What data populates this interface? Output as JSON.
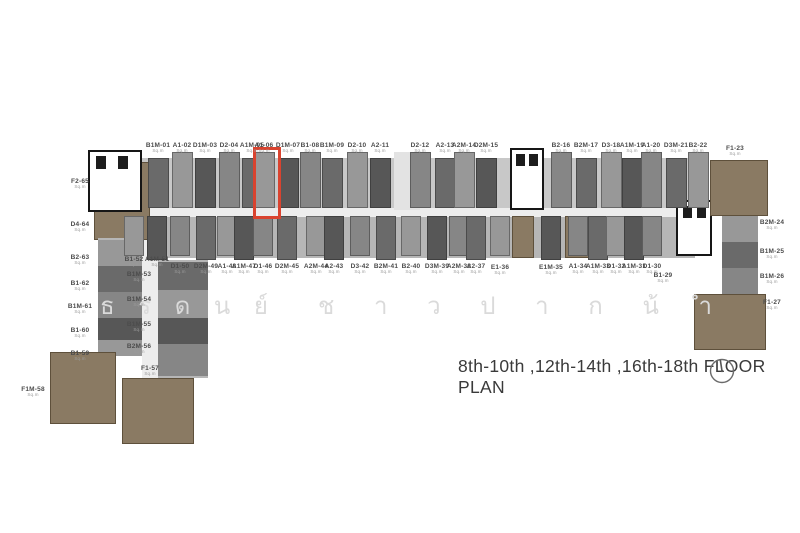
{
  "page": {
    "width": 800,
    "height": 533,
    "background": "#ffffff"
  },
  "caption": {
    "text": "8th-10th ,12th-14th ,16th-18th FLOOR PLAN",
    "icon": "north-indicator"
  },
  "watermark": {
    "text": "ธรดนย์ ชาวปากน้ำ",
    "color": "#dadada",
    "group1": [
      "ธ",
      "ร",
      "ด",
      "น",
      "ย์"
    ],
    "group2": [
      "ช",
      "า",
      "ว",
      "ป",
      "า",
      "ก",
      "น้",
      "ำ"
    ]
  },
  "highlight": {
    "unit_id": "A1-06",
    "color": "#d9432f",
    "x": 253,
    "y": 147,
    "w": 22,
    "h": 66
  },
  "units": {
    "area_label": "Sq.m",
    "top_row": [
      {
        "id": "B1M-01",
        "x": 158
      },
      {
        "id": "A1-02",
        "x": 182
      },
      {
        "id": "D1M-03",
        "x": 205
      },
      {
        "id": "D2-04",
        "x": 229
      },
      {
        "id": "A1M-05",
        "x": 252
      },
      {
        "id": "A1-06",
        "x": 264,
        "highlighted": true
      },
      {
        "id": "D1M-07",
        "x": 288
      },
      {
        "id": "B1-08",
        "x": 310
      },
      {
        "id": "B1M-09",
        "x": 332
      },
      {
        "id": "D2-10",
        "x": 357
      },
      {
        "id": "A2-11",
        "x": 380
      },
      {
        "id": "D2-12",
        "x": 420
      },
      {
        "id": "A2-13",
        "x": 445
      },
      {
        "id": "A2M-14",
        "x": 464
      },
      {
        "id": "D2M-15",
        "x": 486
      },
      {
        "id": "B2-16",
        "x": 561
      },
      {
        "id": "B2M-17",
        "x": 586
      },
      {
        "id": "D3-18",
        "x": 611
      },
      {
        "id": "A1M-19",
        "x": 632
      },
      {
        "id": "A1-20",
        "x": 651
      },
      {
        "id": "D3M-21",
        "x": 676
      },
      {
        "id": "B2-22",
        "x": 698
      },
      {
        "id": "F1-23",
        "x": 735,
        "y": 145,
        "noblock": true
      }
    ],
    "mid_row": [
      {
        "id": "B1-52",
        "x": 134,
        "y": 256
      },
      {
        "id": "A1M-51",
        "x": 157,
        "y": 256
      },
      {
        "id": "D1-50",
        "x": 180
      },
      {
        "id": "D2M-49",
        "x": 206
      },
      {
        "id": "A1-48",
        "x": 227
      },
      {
        "id": "A1M-47",
        "x": 244
      },
      {
        "id": "D1-46",
        "x": 263
      },
      {
        "id": "D2M-45",
        "x": 287
      },
      {
        "id": "A2M-44",
        "x": 316
      },
      {
        "id": "A2-43",
        "x": 334
      },
      {
        "id": "D3-42",
        "x": 360
      },
      {
        "id": "B2M-41",
        "x": 386
      },
      {
        "id": "B2-40",
        "x": 411
      },
      {
        "id": "D3M-39",
        "x": 437
      },
      {
        "id": "A2M-38",
        "x": 459
      },
      {
        "id": "A2-37",
        "x": 476
      },
      {
        "id": "E1-36",
        "x": 500,
        "y": 264
      },
      {
        "id": "E1M-35",
        "x": 551,
        "y": 264
      },
      {
        "id": "A1-34",
        "x": 578
      },
      {
        "id": "A1M-33",
        "x": 598
      },
      {
        "id": "D1-32",
        "x": 616
      },
      {
        "id": "A1M-31",
        "x": 634
      },
      {
        "id": "D1-30",
        "x": 652
      },
      {
        "id": "B1-29",
        "x": 663,
        "y": 272,
        "noblock": true
      }
    ],
    "left_col": [
      {
        "id": "F2-65",
        "y": 178
      },
      {
        "id": "D4-64",
        "y": 221
      },
      {
        "id": "B2-63",
        "y": 254
      },
      {
        "id": "B1-62",
        "y": 280
      },
      {
        "id": "B1M-61",
        "y": 303
      },
      {
        "id": "B1-60",
        "y": 327
      },
      {
        "id": "B1-59",
        "y": 350
      },
      {
        "id": "F1M-58",
        "x": 33,
        "y": 386
      }
    ],
    "inner_left_col": [
      {
        "id": "B1M-53",
        "y": 271
      },
      {
        "id": "B1M-54",
        "y": 296
      },
      {
        "id": "B1M-55",
        "y": 321
      },
      {
        "id": "B2M-56",
        "y": 343
      },
      {
        "id": "F1-57",
        "x": 150,
        "y": 365
      }
    ],
    "right_col": [
      {
        "id": "B2M-24",
        "y": 219
      },
      {
        "id": "B1M-25",
        "y": 248
      },
      {
        "id": "B1M-26",
        "y": 273
      },
      {
        "id": "F1-27",
        "y": 299
      }
    ]
  },
  "colors": {
    "band1": "#c8c8c8",
    "band2": "#b6b6b6",
    "corridor": "#ededed",
    "core": "#ffffff",
    "stair": "#e3e3e3",
    "tan": "#8a7a63",
    "mid": "#989898",
    "dark": "#6a6a6a",
    "dark2": "#575757",
    "mid2": "#868686",
    "wall": "#1d1d1d"
  },
  "plan": {
    "blocks": [
      {
        "x": 142,
        "y": 158,
        "w": 560,
        "h": 50,
        "c": "band1",
        "n": "upper-unit-band",
        "tex": 1
      },
      {
        "x": 150,
        "y": 214,
        "w": 545,
        "h": 44,
        "c": "band2",
        "n": "lower-unit-band",
        "tex": 1
      },
      {
        "x": 140,
        "y": 208,
        "w": 560,
        "h": 9,
        "c": "corridor",
        "n": "central-corridor"
      },
      {
        "x": 94,
        "y": 162,
        "w": 56,
        "h": 78,
        "c": "tan",
        "n": "unit-block-F2-65",
        "u": 1
      },
      {
        "x": 88,
        "y": 150,
        "w": 54,
        "h": 62,
        "c": "core",
        "n": "elevator-core-left",
        "core": 1
      },
      {
        "x": 96,
        "y": 156,
        "w": 10,
        "h": 13,
        "c": "wall",
        "n": "shaft"
      },
      {
        "x": 118,
        "y": 156,
        "w": 10,
        "h": 13,
        "c": "wall",
        "n": "shaft"
      },
      {
        "x": 98,
        "y": 238,
        "w": 44,
        "h": 118,
        "c": "band2",
        "n": "left-wing"
      },
      {
        "x": 98,
        "y": 240,
        "w": 44,
        "h": 26,
        "c": "mid",
        "n": "left-wing-unit"
      },
      {
        "x": 98,
        "y": 266,
        "w": 44,
        "h": 26,
        "c": "dark",
        "n": "left-wing-unit"
      },
      {
        "x": 98,
        "y": 292,
        "w": 44,
        "h": 26,
        "c": "mid2",
        "n": "left-wing-unit"
      },
      {
        "x": 98,
        "y": 318,
        "w": 44,
        "h": 22,
        "c": "dark2",
        "n": "left-wing-unit"
      },
      {
        "x": 98,
        "y": 340,
        "w": 44,
        "h": 16,
        "c": "mid",
        "n": "left-wing-unit"
      },
      {
        "x": 50,
        "y": 352,
        "w": 66,
        "h": 72,
        "c": "tan",
        "n": "unit-block-F1M-58",
        "u": 1
      },
      {
        "x": 142,
        "y": 240,
        "w": 16,
        "h": 138,
        "c": "corridor",
        "n": "left-corridor"
      },
      {
        "x": 158,
        "y": 260,
        "w": 50,
        "h": 118,
        "c": "band2",
        "n": "inner-left-wing"
      },
      {
        "x": 158,
        "y": 262,
        "w": 50,
        "h": 28,
        "c": "dark",
        "n": "inner-wing-unit"
      },
      {
        "x": 158,
        "y": 290,
        "w": 50,
        "h": 28,
        "c": "mid",
        "n": "inner-wing-unit"
      },
      {
        "x": 158,
        "y": 318,
        "w": 50,
        "h": 26,
        "c": "dark2",
        "n": "inner-wing-unit"
      },
      {
        "x": 158,
        "y": 344,
        "w": 50,
        "h": 32,
        "c": "mid2",
        "n": "inner-wing-unit"
      },
      {
        "x": 122,
        "y": 378,
        "w": 72,
        "h": 66,
        "c": "tan",
        "n": "unit-block-F1-57",
        "u": 1
      },
      {
        "x": 394,
        "y": 152,
        "w": 26,
        "h": 58,
        "c": "stair",
        "n": "stair-core"
      },
      {
        "x": 510,
        "y": 148,
        "w": 34,
        "h": 62,
        "c": "core",
        "n": "elevator-core-mid",
        "core": 1
      },
      {
        "x": 516,
        "y": 154,
        "w": 9,
        "h": 12,
        "c": "wall",
        "n": "shaft"
      },
      {
        "x": 529,
        "y": 154,
        "w": 9,
        "h": 12,
        "c": "wall",
        "n": "shaft"
      },
      {
        "x": 676,
        "y": 200,
        "w": 36,
        "h": 56,
        "c": "core",
        "n": "core-right",
        "core": 1
      },
      {
        "x": 683,
        "y": 206,
        "w": 9,
        "h": 12,
        "c": "wall",
        "n": "shaft"
      },
      {
        "x": 697,
        "y": 206,
        "w": 9,
        "h": 12,
        "c": "wall",
        "n": "shaft"
      },
      {
        "x": 710,
        "y": 160,
        "w": 58,
        "h": 56,
        "c": "tan",
        "n": "unit-block-F1-23",
        "u": 1
      },
      {
        "x": 722,
        "y": 216,
        "w": 36,
        "h": 78,
        "c": "band2",
        "n": "right-wing"
      },
      {
        "x": 722,
        "y": 216,
        "w": 36,
        "h": 26,
        "c": "mid",
        "n": "right-wing-unit"
      },
      {
        "x": 722,
        "y": 242,
        "w": 36,
        "h": 26,
        "c": "dark",
        "n": "right-wing-unit"
      },
      {
        "x": 722,
        "y": 268,
        "w": 36,
        "h": 26,
        "c": "mid2",
        "n": "right-wing-unit"
      },
      {
        "x": 694,
        "y": 294,
        "w": 72,
        "h": 56,
        "c": "tan",
        "n": "unit-block-F1-27",
        "u": 1
      },
      {
        "x": 512,
        "y": 216,
        "w": 22,
        "h": 42,
        "c": "tan",
        "n": "unit-lower-tan-a",
        "u": 1
      },
      {
        "x": 565,
        "y": 216,
        "w": 24,
        "h": 42,
        "c": "tan",
        "n": "unit-lower-tan-b",
        "u": 1
      }
    ]
  }
}
